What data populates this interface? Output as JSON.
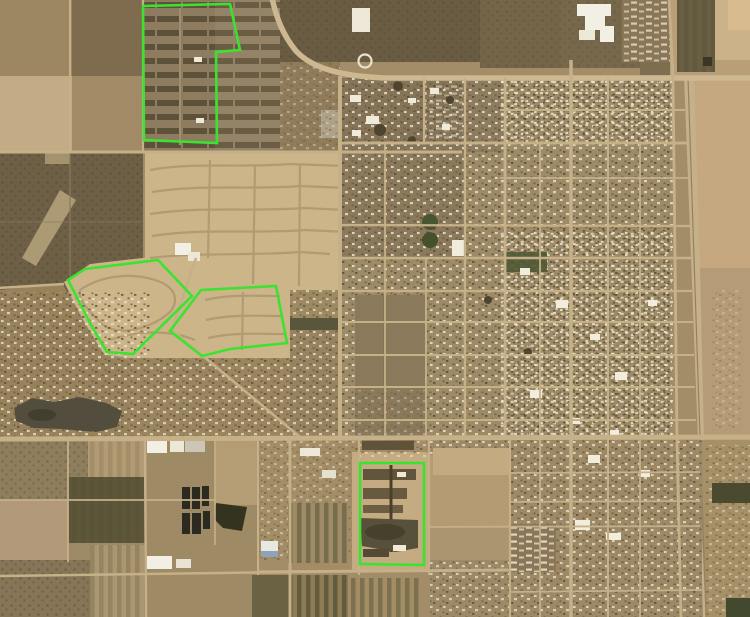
{
  "image": {
    "kind": "satellite-aerial-map",
    "width": 750,
    "height": 617,
    "description": "Aerial/satellite imagery of a desert town: checkerboard farm fields and orchards to the west, new sandy subdivisions in the center-west, a dense urban street grid to the east, agricultural parcels and ponds to the south. Four development parcels are outlined in bright green."
  },
  "palette": {
    "annotation-green": "#3be32f",
    "base-tan": "#a28d68",
    "sand-light": "#cdb58a",
    "urban-tan": "#9d8a66",
    "road-light": "#c6b088",
    "scrub-dark": "#6c5d44",
    "field-olive": "#5d5639",
    "lake-dark": "#524d3d",
    "pond-black": "#2b2a20",
    "building-white": "#f2efe4"
  },
  "annotations": {
    "stroke_width": 2.6,
    "polygons": [
      {
        "name": "annotation-parcel-north-subdivision",
        "points": "143,6 230,4 240,50 216,52 217,143 144,140"
      },
      {
        "name": "annotation-parcel-west-a",
        "points": "158,260 192,296 133,354 107,352 91,325 68,280 85,269"
      },
      {
        "name": "annotation-parcel-west-b",
        "points": "201,290 276,286 287,343 230,349 202,356 170,331"
      },
      {
        "name": "annotation-parcel-south",
        "points": "360,463 424,463 424,565 360,564"
      }
    ]
  }
}
